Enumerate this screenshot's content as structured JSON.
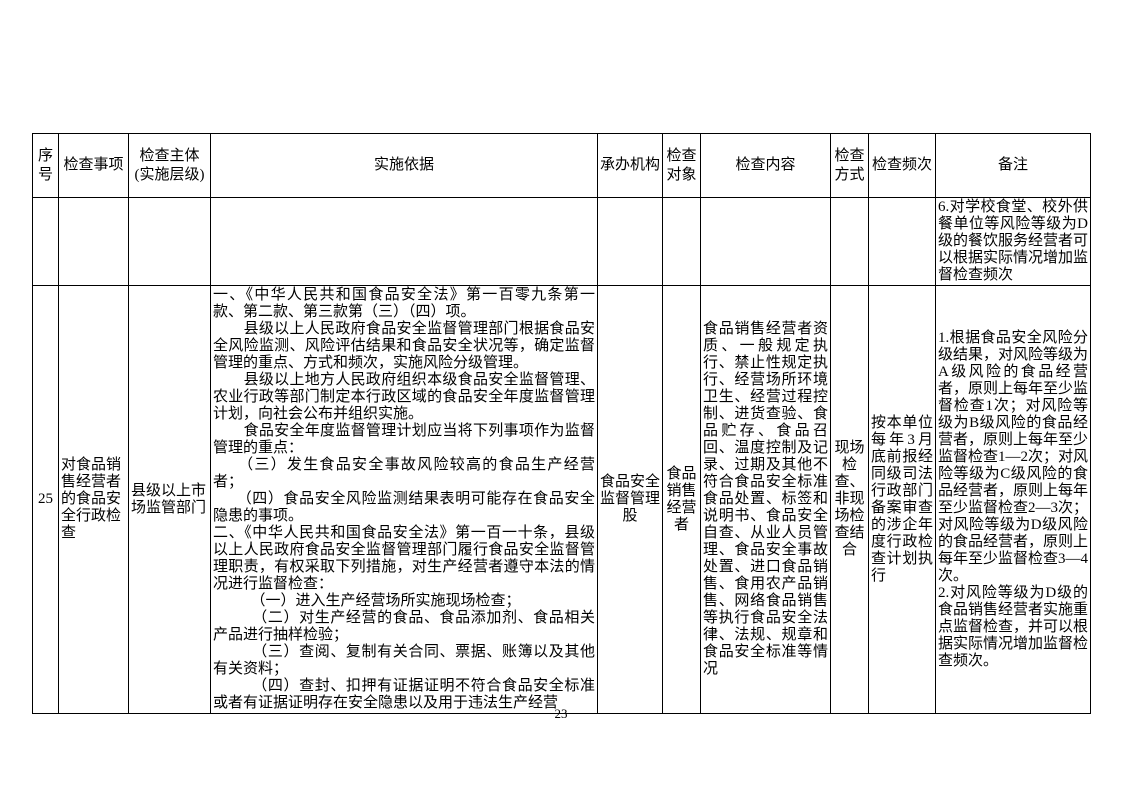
{
  "page": {
    "number": "23"
  },
  "table": {
    "headers": {
      "seq": "序号",
      "item": "检查事项",
      "subject": "检查主体\n(实施层级)",
      "basis": "实施依据",
      "agency": "承办机构",
      "target": "检查对象",
      "content": "检查内容",
      "method": "检查方式",
      "frequency": "检查频次",
      "remark": "备注"
    },
    "rows": [
      {
        "seq": "",
        "item": "",
        "subject": "",
        "basis": "",
        "agency": "",
        "target": "",
        "content": "",
        "method": "",
        "frequency": "",
        "remark": "6.对学校食堂、校外供餐单位等风险等级为D级的餐饮服务经营者可以根据实际情况增加监督检查频次"
      },
      {
        "seq": "25",
        "item": "对食品销售经营者的食品安全行政检查",
        "subject": "县级以上市场监管部门",
        "basis": "一、《中华人民共和国食品安全法》第一百零九条第一款、第二款、第三款第（三）（四）项。\n　　县级以上人民政府食品安全监督管理部门根据食品安全风险监测、风险评估结果和食品安全状况等，确定监督管理的重点、方式和频次，实施风险分级管理。\n　　县级以上地方人民政府组织本级食品安全监督管理、农业行政等部门制定本行政区域的食品安全年度监督管理计划，向社会公布并组织实施。\n　　食品安全年度监督管理计划应当将下列事项作为监督管理的重点：\n　　（三）发生食品安全事故风险较高的食品生产经营者；\n　　（四）食品安全风险监测结果表明可能存在食品安全隐患的事项。\n二、《中华人民共和国食品安全法》第一百一十条，县级以上人民政府食品安全监督管理部门履行食品安全监督管理职责，有权采取下列措施，对生产经营者遵守本法的情况进行监督检查：\n　　　（一）进入生产经营场所实施现场检查；\n　　　（二）对生产经营的食品、食品添加剂、食品相关产品进行抽样检验；\n　　　（三）查阅、复制有关合同、票据、账簿以及其他有关资料；\n　　　（四）查封、扣押有证据证明不符合食品安全标准或者有证据证明存在安全隐患以及用于违法生产经营",
        "agency": "食品安全监督管理股",
        "target": "食品销售经营者",
        "content": "食品销售经营者资质、一般规定执行、禁止性规定执行、经营场所环境卫生、经营过程控制、进货查验、食品贮存、食品召回、温度控制及记录、过期及其他不符合食品安全标准食品处置、标签和说明书、食品安全自查、从业人员管理、食品安全事故处置、进口食品销售、食用农产品销售、网络食品销售等执行食品安全法律、法规、规章和食品安全标准等情况",
        "method": "现场检查、非现场检查结合",
        "frequency": "按本单位每年3月底前报经同级司法行政部门备案审查的涉企年度行政检查计划执行",
        "remark": "1.根据食品安全风险分级结果，对风险等级为A级风险的食品经营者，原则上每年至少监督检查1次；对风险等级为B级风险的食品经营者，原则上每年至少监督检查1—2次；对风险等级为C级风险的食品经营者，原则上每年至少监督检查2—3次；对风险等级为D级风险的食品经营者，原则上每年至少监督检查3—4次。\n2.对风险等级为D级的食品销售经营者实施重点监督检查，并可以根据实际情况增加监督检查频次。"
      }
    ]
  }
}
